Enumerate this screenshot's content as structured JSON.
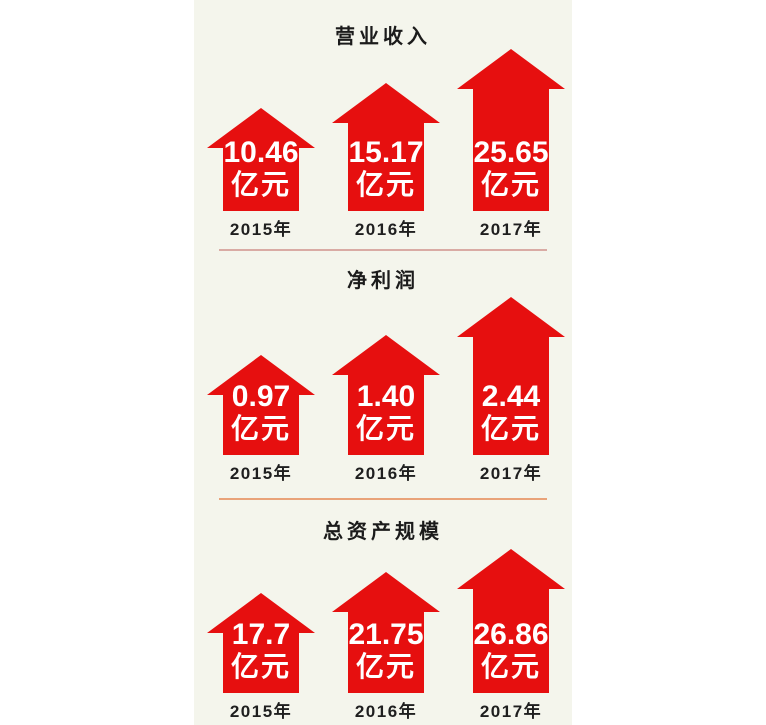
{
  "colors": {
    "arrow_red": "#e60f0f",
    "panel_background": "#f4f5ec",
    "page_background": "#ffffff",
    "divider_top": "#d9aba4",
    "divider_bottom": "#e9a379",
    "title_text": "#1b1b1b",
    "arrow_text": "#ffffff"
  },
  "sections": [
    {
      "title": "营业收入",
      "items": [
        {
          "value": "10.46",
          "unit": "亿元",
          "year": "2015年"
        },
        {
          "value": "15.17",
          "unit": "亿元",
          "year": "2016年"
        },
        {
          "value": "25.65",
          "unit": "亿元",
          "year": "2017年"
        }
      ]
    },
    {
      "title": "净利润",
      "items": [
        {
          "value": "0.97",
          "unit": "亿元",
          "year": "2015年"
        },
        {
          "value": "1.40",
          "unit": "亿元",
          "year": "2016年"
        },
        {
          "value": "2.44",
          "unit": "亿元",
          "year": "2017年"
        }
      ]
    },
    {
      "title": "总资产规模",
      "items": [
        {
          "value": "17.7",
          "unit": "亿元",
          "year": "2015年"
        },
        {
          "value": "21.75",
          "unit": "亿元",
          "year": "2016年"
        },
        {
          "value": "26.86",
          "unit": "亿元",
          "year": "2017年"
        }
      ]
    }
  ],
  "chart_data": [
    {
      "type": "bar",
      "title": "营业收入",
      "categories": [
        "2015年",
        "2016年",
        "2017年"
      ],
      "values": [
        10.46,
        15.17,
        25.65
      ],
      "unit": "亿元",
      "xlabel": "年份",
      "ylabel": "营业收入(亿元)",
      "legend": "none",
      "grid": false,
      "marker_style": "red-up-arrow"
    },
    {
      "type": "bar",
      "title": "净利润",
      "categories": [
        "2015年",
        "2016年",
        "2017年"
      ],
      "values": [
        0.97,
        1.4,
        2.44
      ],
      "unit": "亿元",
      "xlabel": "年份",
      "ylabel": "净利润(亿元)",
      "legend": "none",
      "grid": false,
      "marker_style": "red-up-arrow"
    },
    {
      "type": "bar",
      "title": "总资产规模",
      "categories": [
        "2015年",
        "2016年",
        "2017年"
      ],
      "values": [
        17.7,
        21.75,
        26.86
      ],
      "unit": "亿元",
      "xlabel": "年份",
      "ylabel": "总资产规模(亿元)",
      "legend": "none",
      "grid": false,
      "marker_style": "red-up-arrow"
    }
  ]
}
